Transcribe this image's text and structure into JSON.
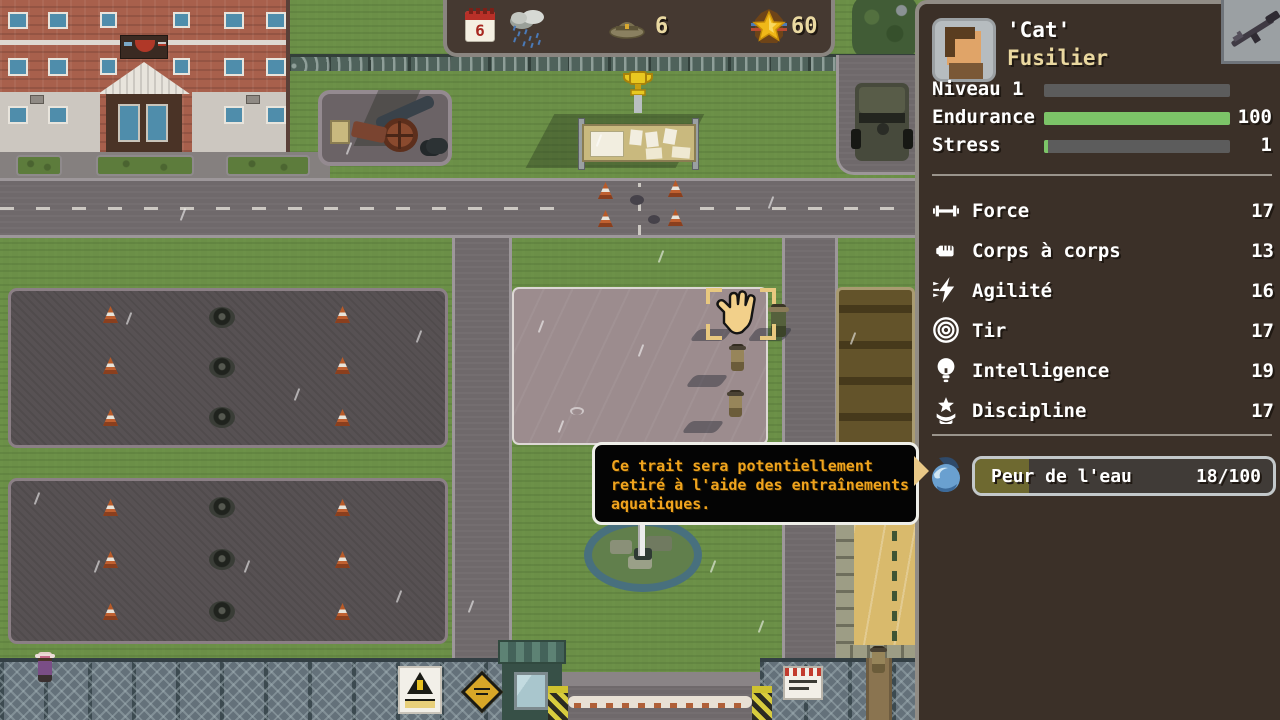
{
  "topbar": {
    "day": "6",
    "recruits": "6",
    "medals": "60"
  },
  "sidebar": {
    "name": "'Cat'",
    "role": "Fusilier",
    "stats": [
      {
        "label": "Niveau 1",
        "value": "",
        "pct": 0,
        "color": "#5c5c5c"
      },
      {
        "label": "Endurance",
        "value": "100",
        "pct": 100,
        "color": "#7cc468"
      },
      {
        "label": "Stress",
        "value": "1",
        "pct": 2,
        "color": "#7cc468"
      }
    ],
    "attributes": [
      {
        "label": "Force",
        "value": "17",
        "icon": "dumbbell"
      },
      {
        "label": "Corps à corps",
        "value": "13",
        "icon": "fist"
      },
      {
        "label": "Agilité",
        "value": "16",
        "icon": "lightning"
      },
      {
        "label": "Tir",
        "value": "17",
        "icon": "target"
      },
      {
        "label": "Intelligence",
        "value": "19",
        "icon": "lightbulb"
      },
      {
        "label": "Discipline",
        "value": "17",
        "icon": "star-chevrons"
      }
    ],
    "trait": {
      "label": "Peur de l'eau",
      "value": "18/100",
      "pct": 18,
      "fill_color": "#6e6930",
      "icon": "water-wave"
    }
  },
  "tooltip": {
    "lines": [
      "Ce trait sera potentiellement",
      "retiré à l'aide des entraînements",
      "aquatiques."
    ],
    "text_color": "#f0a41e"
  },
  "colors": {
    "sidebar_bg": "#3b3028",
    "endurance_green": "#7cc468",
    "role_yellow": "#ead8a0",
    "hud_cream": "#ead9a2",
    "grass": "#6b8f47",
    "parade_ground": "#9c8c8e"
  },
  "icons": {
    "calendar": "calendar-page",
    "weather": "rain-cloud",
    "recruits": "campaign-hat",
    "medals": "star-medal",
    "weapon_slot": "rifle"
  }
}
